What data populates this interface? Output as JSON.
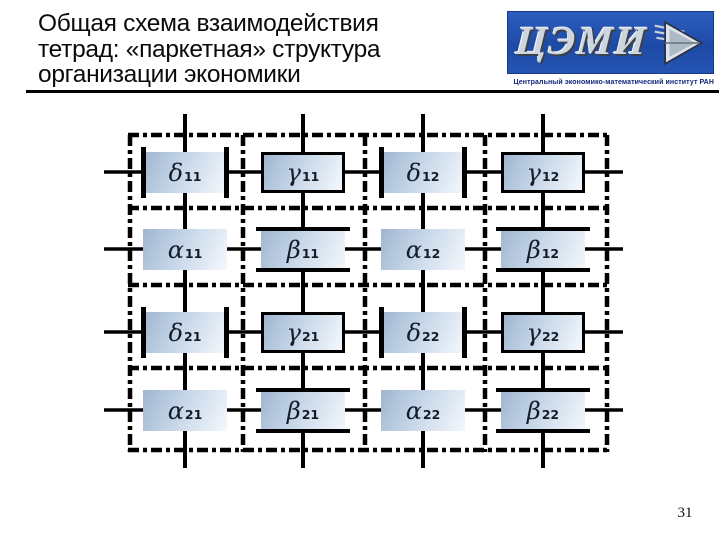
{
  "slide": {
    "title_lines": [
      "Общая схема взаимодействия",
      "тетрад: «паркетная» структура",
      "организации экономики"
    ],
    "page_number": "31"
  },
  "logo": {
    "text": "ЦЭМИ",
    "caption": "Центральный экономико-математический институт РАН",
    "background_color": "#1d4aa4",
    "arrow_icon": "right-arrow-icon"
  },
  "diagram": {
    "grid": {
      "rows": 4,
      "cols": 4
    },
    "colors": {
      "box_gradient_start": "#9fb6d0",
      "box_gradient_end": "#f4f8fc",
      "line_color": "#000000",
      "label_color": "#141c2b"
    },
    "boxes": [
      {
        "letter": "δ",
        "sub": "11",
        "type": "delta"
      },
      {
        "letter": "γ",
        "sub": "11",
        "type": "gamma"
      },
      {
        "letter": "δ",
        "sub": "12",
        "type": "delta"
      },
      {
        "letter": "γ",
        "sub": "12",
        "type": "gamma"
      },
      {
        "letter": "α",
        "sub": "11",
        "type": "alpha"
      },
      {
        "letter": "β",
        "sub": "11",
        "type": "beta"
      },
      {
        "letter": "α",
        "sub": "12",
        "type": "alpha"
      },
      {
        "letter": "β",
        "sub": "12",
        "type": "beta"
      },
      {
        "letter": "δ",
        "sub": "21",
        "type": "delta"
      },
      {
        "letter": "γ",
        "sub": "21",
        "type": "gamma"
      },
      {
        "letter": "δ",
        "sub": "22",
        "type": "delta"
      },
      {
        "letter": "γ",
        "sub": "22",
        "type": "gamma"
      },
      {
        "letter": "α",
        "sub": "21",
        "type": "alpha"
      },
      {
        "letter": "β",
        "sub": "21",
        "type": "beta"
      },
      {
        "letter": "α",
        "sub": "22",
        "type": "alpha"
      },
      {
        "letter": "β",
        "sub": "22",
        "type": "beta"
      }
    ]
  }
}
